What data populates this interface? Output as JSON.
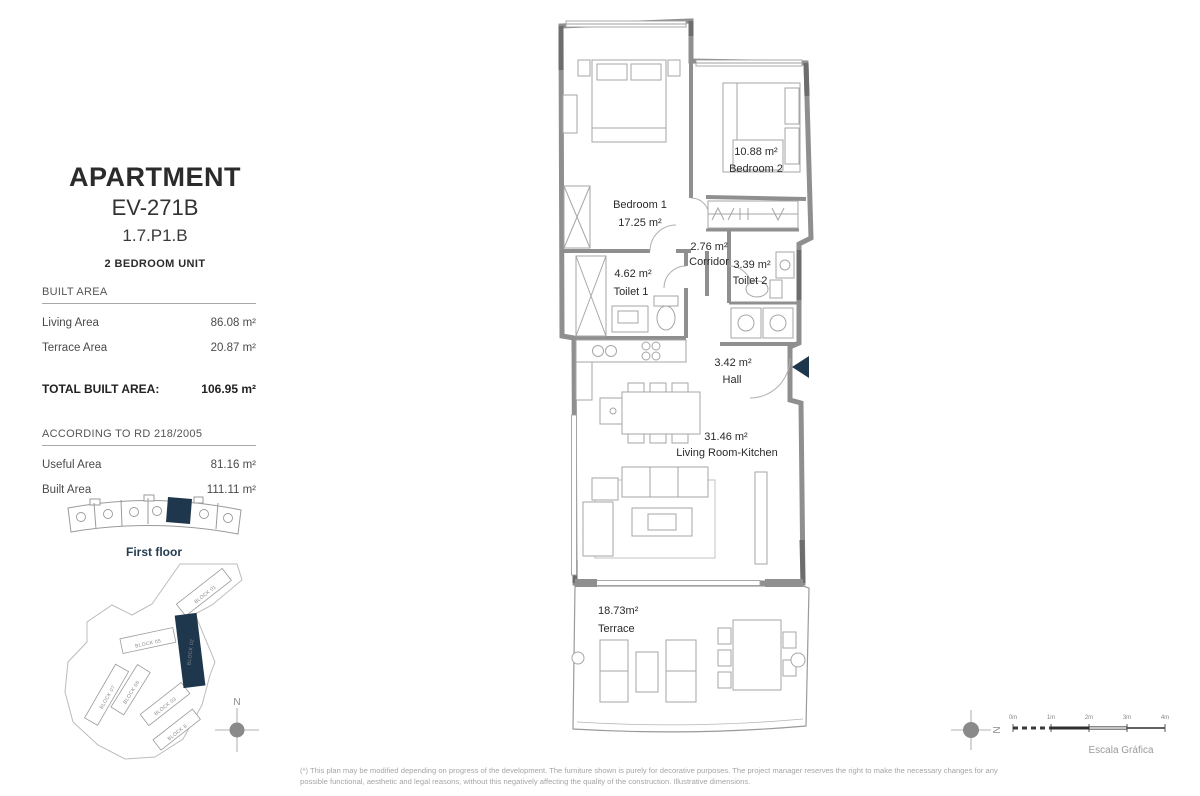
{
  "colors": {
    "accent": "#1e374d",
    "wall": "#8f8f8f",
    "wall_dark": "#6d6d6d",
    "furniture_line": "#a6a6a6",
    "text_dark": "#2b2b2b",
    "text_gray": "#9e9e9e"
  },
  "header": {
    "title": "APARTMENT",
    "unit_code": "EV-271B",
    "unit_ref": "1.7.P1.B",
    "unit_type": "2 BEDROOM UNIT"
  },
  "built_area": {
    "header": "BUILT AREA",
    "rows": [
      {
        "label": "Living Area",
        "value": "86.08 m²"
      },
      {
        "label": "Terrace Area",
        "value": "20.87 m²"
      }
    ],
    "total_label": "TOTAL BUILT AREA:",
    "total_value": "106.95 m²"
  },
  "rd_area": {
    "header": "ACCORDING TO RD 218/2005",
    "rows": [
      {
        "label": "Useful Area",
        "value": "81.16 m²"
      },
      {
        "label": "Built Area",
        "value": "111.11 m²"
      }
    ]
  },
  "key_plan": {
    "floor_label": "First floor",
    "compass_label": "N"
  },
  "site_plan": {
    "blocks": [
      {
        "label": "BLOCK 01"
      },
      {
        "label": "BLOCK 05"
      },
      {
        "label": "BLOCK 02",
        "highlighted": true
      },
      {
        "label": "BLOCK 06"
      },
      {
        "label": "BLOCK 07"
      },
      {
        "label": "BLOCK 03"
      },
      {
        "label": "BLOCK 8"
      }
    ]
  },
  "floor_plan": {
    "rooms": [
      {
        "name": "Bedroom 1",
        "area": "17.25 m²"
      },
      {
        "name": "Bedroom 2",
        "area": "10.88 m²"
      },
      {
        "name": "Corridor",
        "area": "2.76 m²"
      },
      {
        "name": "Toilet 1",
        "area": "4.62 m²"
      },
      {
        "name": "Toilet 2",
        "area": "3.39 m²"
      },
      {
        "name": "Hall",
        "area": "3.42 m²"
      },
      {
        "name": "Living Room-Kitchen",
        "area": "31.46 m²"
      },
      {
        "name": "Terrace",
        "area": "18.73m²"
      }
    ]
  },
  "scale_bar": {
    "ticks": [
      "0m",
      "1m",
      "2m",
      "3m",
      "4m"
    ],
    "label": "Escala Gráfica",
    "compass_label": "N"
  },
  "footnote": {
    "line1": "(*) This plan may be modified depending on progress of the development. The furniture shown is purely for decorative purposes. The project manager reserves the right to make the necessary changes for any",
    "line2": "possible functional, aesthetic and legal reasons, without this negatively affecting the quality of the construction. Illustrative dimensions."
  }
}
